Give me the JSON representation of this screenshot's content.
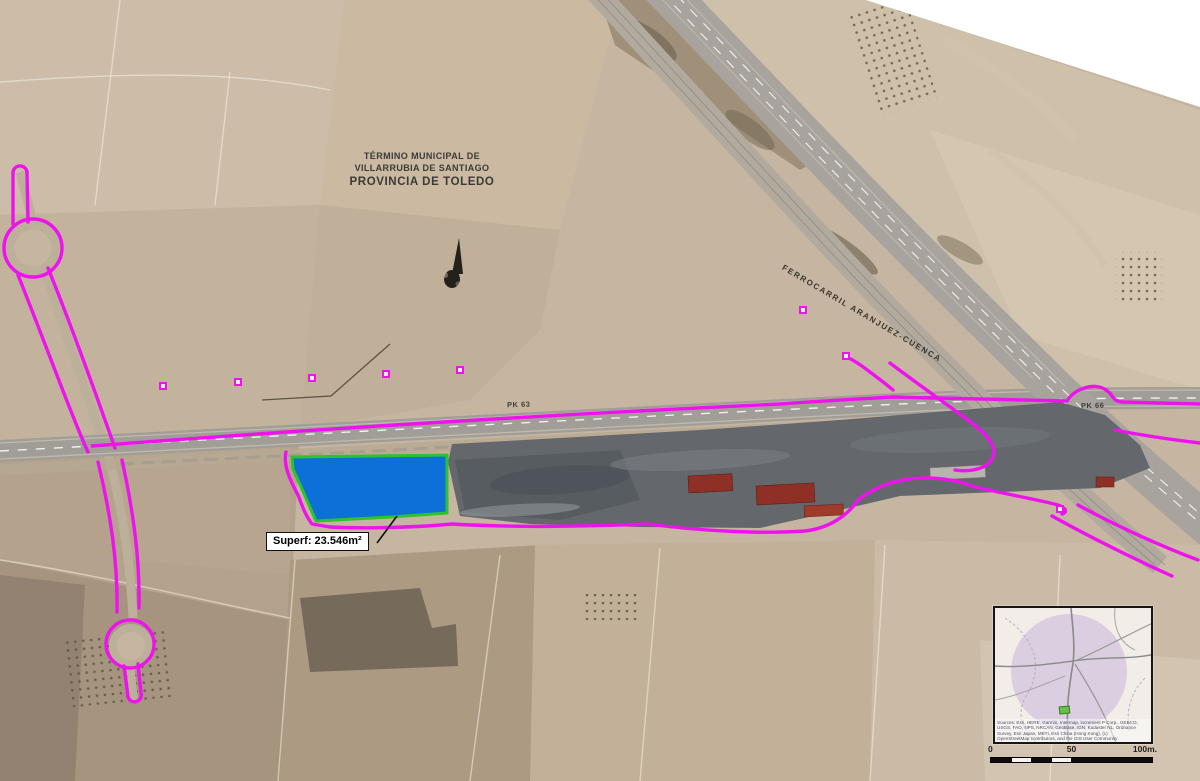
{
  "labels": {
    "municipality": {
      "lines": [
        "TÉRMINO MUNICIPAL DE",
        "VILLARRUBIA DE SANTIAGO",
        "PROVINCIA DE TOLEDO"
      ]
    },
    "parcel_area": "Superf: 23.546m²",
    "railway": "FERROCARRIL ARANJUEZ-CUENCA",
    "pk_marker_west": "PK 63",
    "pk_marker_east": "PK 66"
  },
  "inset": {
    "attribution_lines": [
      "Sources: Esri, HERE, Garmin, Intermap, increment P Corp., GEBCO,",
      "USGS, FAO, NPS, NRCAN, GeoBase, IGN, Kadaster NL, Ordnance",
      "Survey, Esri Japan, METI, Esri China (Hong Kong), (c)",
      "OpenStreetMap contributors, and the GIS User Community"
    ],
    "scale": {
      "tick_0": "0",
      "tick_50": "50",
      "tick_100": "100m."
    }
  },
  "colors": {
    "boundary_magenta": "#ee12ee",
    "parcel_fill": "#0c70d8",
    "parcel_outline": "#2dc32d",
    "terrain_tan": "#c6b5a0",
    "inset_circle": "#cdb9dd",
    "industrial_gray": "#62666a",
    "building_red": "#8e3026"
  }
}
